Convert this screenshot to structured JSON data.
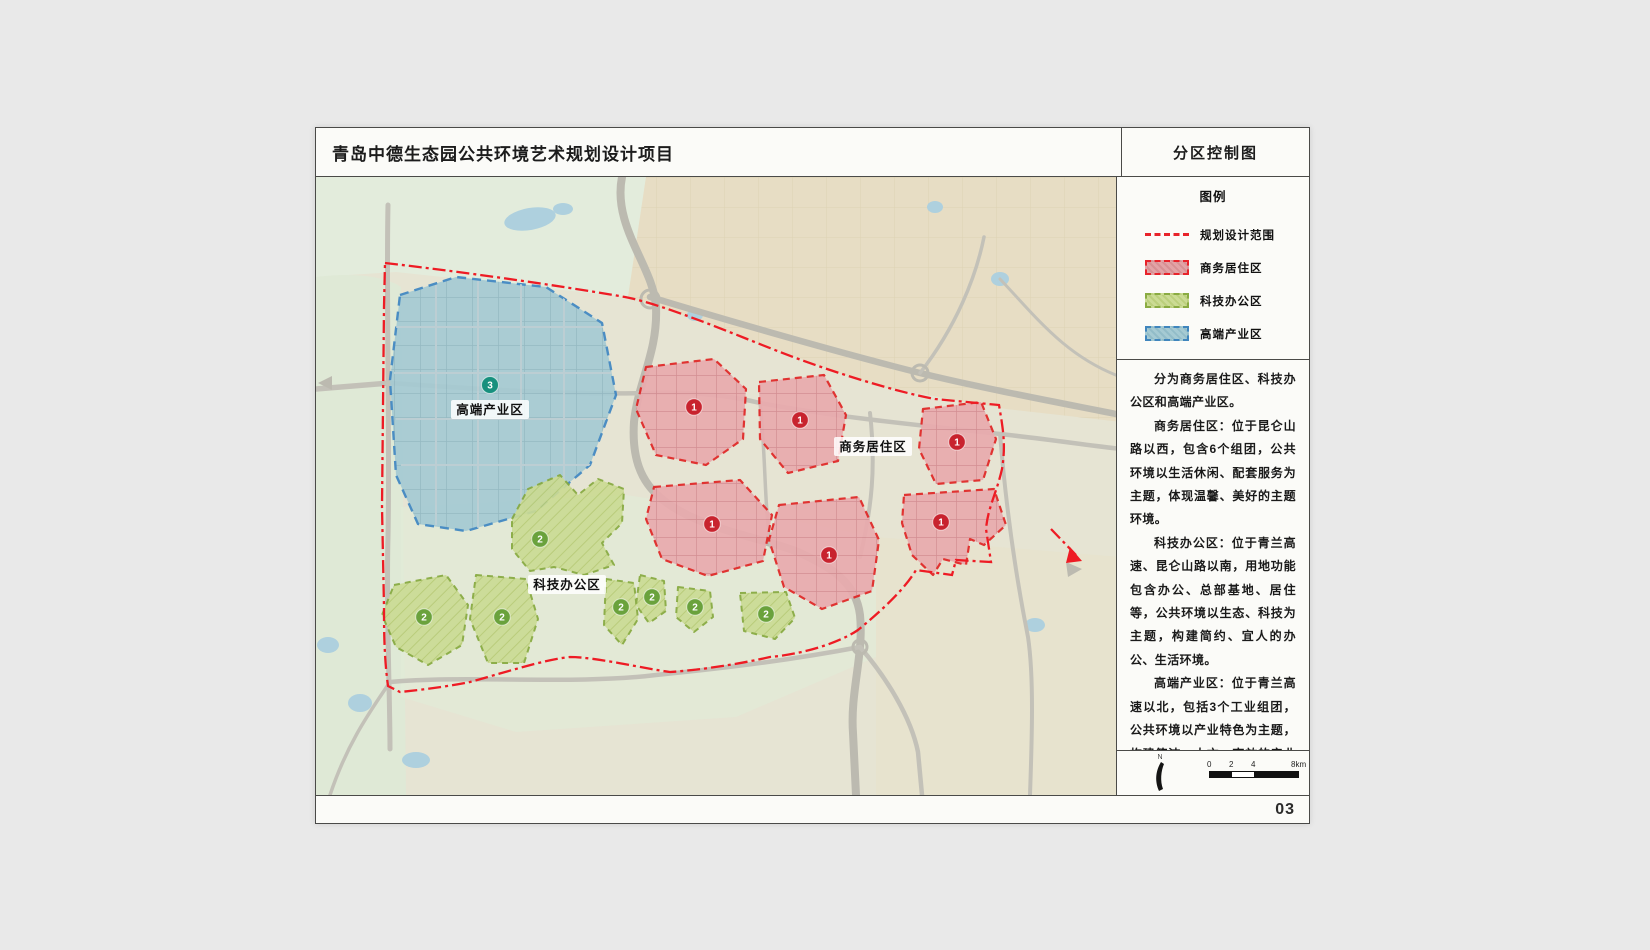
{
  "page": {
    "title": "青岛中德生态园公共环境艺术规划设计项目",
    "page_number": "03"
  },
  "sidebar": {
    "title": "分区控制图",
    "legend": {
      "heading": "图例",
      "items": [
        {
          "label": "规划设计范围",
          "swatch": "dashed-line",
          "color": "#e8232b"
        },
        {
          "label": "商务居住区",
          "swatch": "hatch-box",
          "fill": "#e2a3a6",
          "border": "#e8232b"
        },
        {
          "label": "科技办公区",
          "swatch": "hatch-box",
          "fill": "#cbdb94",
          "border": "#8aab42"
        },
        {
          "label": "高端产业区",
          "swatch": "hatch-box",
          "fill": "#a5cad3",
          "border": "#3f85bd"
        }
      ]
    },
    "description": {
      "paragraphs": [
        "分为商务居住区、科技办公区和高端产业区。",
        "商务居住区：位于昆仑山路以西，包含6个组团，公共环境以生活休闲、配套服务为主题，体现温馨、美好的主题环境。",
        "科技办公区：位于青兰高速、昆仑山路以南，用地功能包含办公、总部基地、居住等，公共环境以生态、科技为主题，构建简约、宜人的办公、生活环境。",
        "高端产业区：位于青兰高速以北，包括3个工业组团，公共环境以产业特色为主题，构建简洁、大方、高效的产业环境。"
      ]
    },
    "north_label": "N",
    "scale_bar": {
      "ticks": [
        "0",
        "2",
        "4",
        "8km"
      ]
    }
  },
  "map": {
    "boundary_label": "规划设计范围",
    "zones": [
      {
        "label": "商务居住区",
        "number": "1",
        "parcel_count": 6,
        "fill": "#e9abae",
        "border": "#e02424",
        "marker_color": "#c8232e"
      },
      {
        "label": "科技办公区",
        "number": "2",
        "parcel_count": 7,
        "fill": "#cbdb94",
        "border": "#86a93f",
        "marker_color": "#6aa23c"
      },
      {
        "label": "高端产业区",
        "number": "3",
        "parcel_count": 1,
        "fill": "#a5cad3",
        "border": "#3e86c2",
        "marker_color": "#17907e"
      }
    ]
  }
}
